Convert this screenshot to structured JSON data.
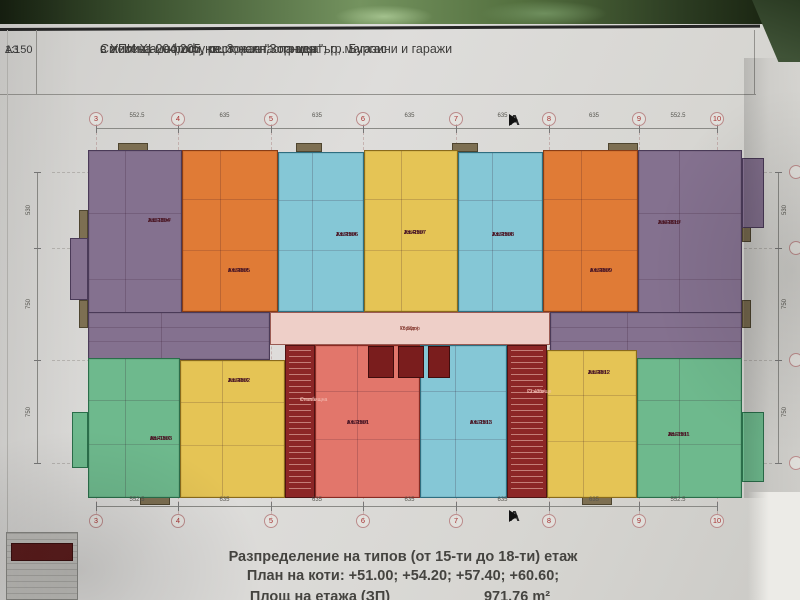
{
  "sheet": {
    "format": "A3",
    "scale": "1:150",
    "title_lines": [
      "Смесена многофункционална сграда",
      "с жилища, офиси, ресторант, спа център, магазини и  гаражи",
      "в УПИ XI-204,205, кв. 3, ж.к. \"Зорница\", гр. Бургас"
    ],
    "footer_line1": "Разпределение на типов  (от 15-ти до 18-ти) етаж",
    "footer_line2": "План на коти:  +51.00; +54.20; +57.40; +60.60;",
    "footer_line3_label": "Площ на етажа (ЗП)",
    "footer_line3_value": "971.76 m²"
  },
  "grid": {
    "column_bubbles": [
      "3",
      "4",
      "5",
      "6",
      "7",
      "8",
      "9",
      "10"
    ],
    "span_dims": [
      "552.5",
      "635",
      "635",
      "635",
      "635",
      "635",
      "552.5"
    ],
    "side_dims": [
      "530",
      "750",
      "750"
    ],
    "section_marker": "A",
    "layout": {
      "column_x": [
        96,
        178,
        271,
        363,
        456,
        549,
        639,
        717
      ],
      "row_y": [
        172,
        248,
        360,
        463
      ],
      "top_line_y": 128,
      "top_bubble_cy": 119,
      "top_dim_y": 113,
      "top_marker_y": 120,
      "bottom_line_y": 506,
      "bottom_bubble_cy": 521,
      "bottom_dim_y": 497,
      "bottom_marker_y": 516,
      "left_rail_x": 37,
      "right_rail_x": 778,
      "right_bubble_cx": 796,
      "marker_x": 509
    }
  },
  "plan": {
    "units": [
      {
        "name": "apartment-1504",
        "color": "#84718f",
        "wall": "#4a3a58",
        "x": 88,
        "y": 150,
        "w": 94,
        "h": 210,
        "lx": 148,
        "ly": 218,
        "lines": [
          "Ап. 1504",
          "Ап. 1604",
          "Ап. 1704",
          "Ап. 1804",
          "2 BR",
          "103.28m²"
        ]
      },
      {
        "name": "apartment-1505",
        "color": "#e07b36",
        "wall": "#8a3c14",
        "x": 182,
        "y": 150,
        "w": 96,
        "h": 162,
        "lx": 228,
        "ly": 268,
        "lines": [
          "Ап. 1505",
          "Ап. 1605",
          "Ап. 1705",
          "Ап. 1805",
          "1 BR",
          "67.94m²"
        ]
      },
      {
        "name": "apartment-1506",
        "color": "#85c7d6",
        "wall": "#2e6e80",
        "x": 278,
        "y": 152,
        "w": 86,
        "h": 160,
        "lx": 336,
        "ly": 232,
        "lines": [
          "Ап. 1506",
          "Ап. 1606",
          "Ап. 1706",
          "Ап. 1806",
          "1 BR",
          "73.93m²"
        ]
      },
      {
        "name": "apartment-1507",
        "color": "#e5c455",
        "wall": "#8a6a1a",
        "x": 364,
        "y": 150,
        "w": 94,
        "h": 162,
        "lx": 404,
        "ly": 230,
        "lines": [
          "Ап. 1507",
          "Ап. 1607",
          "Ап. 1707",
          "Ап. 1807",
          "1 BR",
          "75.48m²"
        ]
      },
      {
        "name": "apartment-1508",
        "color": "#85c7d6",
        "wall": "#2e6e80",
        "x": 458,
        "y": 152,
        "w": 85,
        "h": 160,
        "lx": 492,
        "ly": 232,
        "lines": [
          "Ап. 1508",
          "Ап. 1608",
          "Ап. 1708",
          "Ап. 1808",
          "1 BR",
          "73.93m²"
        ]
      },
      {
        "name": "apartment-1509",
        "color": "#e07b36",
        "wall": "#8a3c14",
        "x": 543,
        "y": 150,
        "w": 95,
        "h": 162,
        "lx": 590,
        "ly": 268,
        "lines": [
          "Ап. 1509",
          "Ап. 1609",
          "Ап. 1709",
          "Ап. 1809",
          "1 BR",
          "67.94m²"
        ]
      },
      {
        "name": "apartment-1510",
        "color": "#84718f",
        "wall": "#4a3a58",
        "x": 638,
        "y": 150,
        "w": 104,
        "h": 210,
        "lx": 658,
        "ly": 220,
        "lines": [
          "Ап. 1510",
          "Ап. 1610",
          "Ап. 1710",
          "Ап. 1810",
          "2 BR",
          "104.49m²"
        ]
      },
      {
        "name": "apartment-1504-lower-rooms",
        "color": "#84718f",
        "wall": "#4a3a58",
        "x": 88,
        "y": 312,
        "w": 182,
        "h": 48
      },
      {
        "name": "apartment-1510-lower-rooms",
        "color": "#84718f",
        "wall": "#4a3a58",
        "x": 550,
        "y": 312,
        "w": 192,
        "h": 48
      },
      {
        "name": "apartment-1503",
        "color": "#6eb98d",
        "wall": "#2a6e4a",
        "x": 88,
        "y": 358,
        "w": 92,
        "h": 140,
        "lx": 150,
        "ly": 436,
        "lines": [
          "Ап. 1503",
          "Ап. 1603",
          "Ап. 1703",
          "Ап. 1803",
          "1BR",
          "69.49m²"
        ]
      },
      {
        "name": "apartment-1502",
        "color": "#e5c455",
        "wall": "#8a6a1a",
        "x": 180,
        "y": 360,
        "w": 105,
        "h": 138,
        "lx": 228,
        "ly": 378,
        "lines": [
          "Ап. 1502",
          "Ап. 1602",
          "Ап. 1702",
          "Ап. 1802",
          "1 BR",
          "70.04m²"
        ]
      },
      {
        "name": "apartment-1501",
        "color": "#e2766b",
        "wall": "#8a2a22",
        "x": 315,
        "y": 345,
        "w": 105,
        "h": 153,
        "lx": 347,
        "ly": 420,
        "lines": [
          "Ап. 1501",
          "Ап. 1601",
          "Ап. 1701",
          "Ап. 1801",
          "1 BR",
          "67.18m²"
        ]
      },
      {
        "name": "apartment-1513",
        "color": "#85c7d6",
        "wall": "#2e6e80",
        "x": 420,
        "y": 345,
        "w": 87,
        "h": 153,
        "lx": 470,
        "ly": 420,
        "lines": [
          "Ап. 1513",
          "Ап. 1613",
          "Ап. 1713",
          "Ап. 1813",
          "1 BR",
          "67.18m²"
        ]
      },
      {
        "name": "apartment-1512",
        "color": "#e5c455",
        "wall": "#8a6a1a",
        "x": 547,
        "y": 350,
        "w": 90,
        "h": 148,
        "lx": 588,
        "ly": 370,
        "lines": [
          "Ап. 1512",
          "Ап. 1612",
          "Ап. 1712",
          "Ап. 1812",
          "1 BR",
          "70.04m²"
        ]
      },
      {
        "name": "apartment-1511",
        "color": "#6eb98d",
        "wall": "#2a6e4a",
        "x": 637,
        "y": 358,
        "w": 105,
        "h": 140,
        "lx": 668,
        "ly": 432,
        "lines": [
          "Ап. 1511",
          "Ап. 1611",
          "Ап. 1711",
          "Ап. 1811",
          "1BR",
          "70.03m²"
        ]
      }
    ],
    "zones": [
      {
        "name": "corridor",
        "color": "#eecfc8",
        "wall": "#9a5a52",
        "x": 270,
        "y": 312,
        "w": 280,
        "h": 33
      },
      {
        "name": "stairwell-left",
        "color": "#8c2626",
        "wall": "#4f1212",
        "x": 285,
        "y": 345,
        "w": 30,
        "h": 153,
        "stairs": true
      },
      {
        "name": "stairwell-right",
        "color": "#8c2626",
        "wall": "#4f1212",
        "x": 507,
        "y": 345,
        "w": 40,
        "h": 153,
        "stairs": true
      },
      {
        "name": "elevator-1",
        "color": "#7a1d1d",
        "wall": "#400d0d",
        "x": 368,
        "y": 346,
        "w": 26,
        "h": 32
      },
      {
        "name": "elevator-2",
        "color": "#7a1d1d",
        "wall": "#400d0d",
        "x": 398,
        "y": 346,
        "w": 26,
        "h": 32
      },
      {
        "name": "elevator-3",
        "color": "#7a1d1d",
        "wall": "#400d0d",
        "x": 428,
        "y": 346,
        "w": 22,
        "h": 32
      }
    ],
    "zone_labels": [
      {
        "name": "corridor-label",
        "x": 400,
        "y": 327,
        "color": "#7a2a20",
        "lines": [
          "Коридор",
          "76.81m²"
        ]
      },
      {
        "name": "stairwell-left-label",
        "x": 300,
        "y": 398,
        "color": "#f3beb4",
        "lines": [
          "Стълбищна",
          "клетка"
        ]
      },
      {
        "name": "stairwell-right-label",
        "x": 527,
        "y": 390,
        "color": "#f3beb4",
        "lines": [
          "Стълбище",
          "22.42m²"
        ]
      }
    ],
    "balconies": [
      {
        "x": 118,
        "y": 143,
        "w": 30,
        "h": 9
      },
      {
        "x": 296,
        "y": 143,
        "w": 26,
        "h": 9
      },
      {
        "x": 452,
        "y": 143,
        "w": 26,
        "h": 9
      },
      {
        "x": 608,
        "y": 143,
        "w": 30,
        "h": 9
      },
      {
        "x": 140,
        "y": 496,
        "w": 30,
        "h": 9
      },
      {
        "x": 582,
        "y": 496,
        "w": 30,
        "h": 9
      },
      {
        "x": 79,
        "y": 210,
        "w": 9,
        "h": 32
      },
      {
        "x": 79,
        "y": 300,
        "w": 9,
        "h": 28
      },
      {
        "x": 742,
        "y": 210,
        "w": 9,
        "h": 32
      },
      {
        "x": 742,
        "y": 300,
        "w": 9,
        "h": 28
      },
      {
        "x": 70,
        "y": 238,
        "w": 18,
        "h": 62,
        "color": "#84718f",
        "wall": "#4a3a58"
      },
      {
        "x": 72,
        "y": 412,
        "w": 16,
        "h": 56,
        "color": "#6eb98d",
        "wall": "#2a6e4a"
      },
      {
        "x": 742,
        "y": 158,
        "w": 22,
        "h": 70,
        "color": "#84718f",
        "wall": "#4a3a58"
      },
      {
        "x": 742,
        "y": 412,
        "w": 22,
        "h": 70,
        "color": "#6eb98d",
        "wall": "#2a6e4a"
      }
    ]
  }
}
